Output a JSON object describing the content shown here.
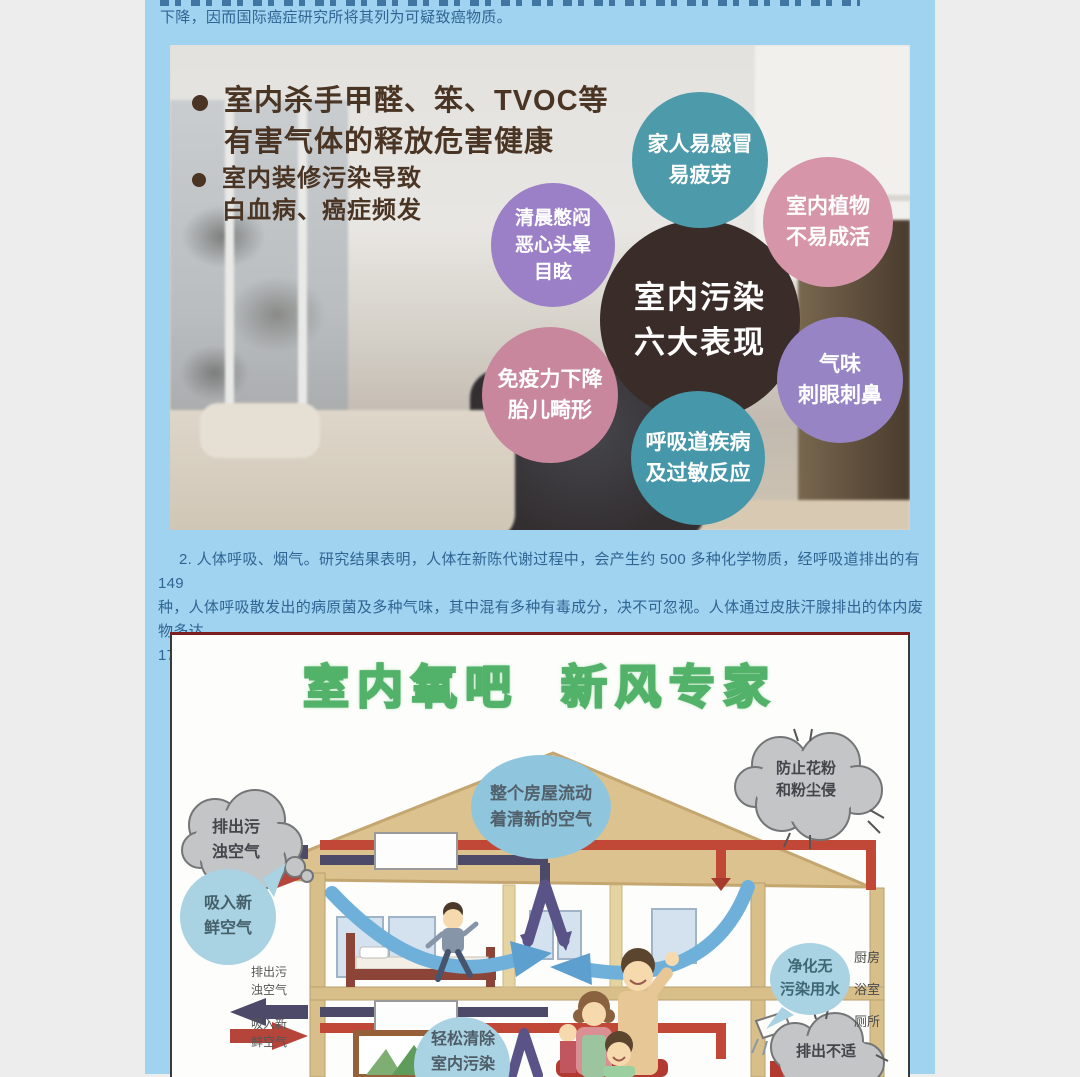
{
  "article": {
    "line_cut": "下降，因而国际癌症研究所将其列为可疑致癌物质。",
    "para2": {
      "l1": "2. 人体呼吸、烟气。研究结果表明，人体在新陈代谢过程中，会产生约 500 多种化学物质，经呼吸道排出的有 149",
      "l2": "种，人体呼吸散发出的病原菌及多种气味，其中混有多种有毒成分，决不可忽视。人体通过皮肤汗腺排出的体内废物多达",
      "l3": "171 种，例如尿素、氨等。"
    }
  },
  "info1": {
    "bullet1_l1": "室内杀手甲醛、笨、TVOC等",
    "bullet1_l2": "有害气体的释放危害健康",
    "bullet2_l1": "室内装修污染导致",
    "bullet2_l2": "白血病、癌症频发",
    "center_l1": "室内污染",
    "center_l2": "六大表现",
    "c_family_l1": "家人易感冒",
    "c_family_l2": "易疲劳",
    "c_plant_l1": "室内植物",
    "c_plant_l2": "不易成活",
    "c_morning_l1": "清晨憋闷",
    "c_morning_l2": "恶心头晕",
    "c_morning_l3": "目眩",
    "c_immune_l1": "免疫力下降",
    "c_immune_l2": "胎儿畸形",
    "c_resp_l1": "呼吸道疾病",
    "c_resp_l2": "及过敏反应",
    "c_odor_l1": "气味",
    "c_odor_l2": "刺眼刺鼻",
    "colors": {
      "center": "#3a2d29",
      "family": "#4d9aab",
      "plant": "#d695a9",
      "morning": "#9b7fc7",
      "immune": "#c9879d",
      "resp": "#4697a9",
      "odor": "#9784c5"
    }
  },
  "info2": {
    "title1": "室内氧吧",
    "title2": "新风专家",
    "roof_l1": "整个房屋流动",
    "roof_l2": "着清新的空气",
    "pollen_l1": "防止花粉",
    "pollen_l2": "和粉尘侵",
    "exhaust_l1": "排出污",
    "exhaust_l2": "浊空气",
    "fresh_l1": "吸入新",
    "fresh_l2": "鲜空气",
    "exhaust_s_l1": "排出污",
    "exhaust_s_l2": "浊空气",
    "fresh_s_l1": "吸入新",
    "fresh_s_l2": "鲜空气",
    "clean_l1": "轻松清除",
    "clean_l2": "室内污染",
    "water_l1": "净化无",
    "water_l2": "污染用水",
    "out_l1": "排出不适",
    "room1": "厨房",
    "room2": "浴室",
    "room3": "厕所",
    "colors": {
      "title_green": "#53b269",
      "pipe_red": "#c14837",
      "pipe_navy": "#4c4a68",
      "bubble_blue": "#a9d2e3"
    }
  },
  "page_colors": {
    "column_bg": "#a0d3f0",
    "margin_bg": "#ededed",
    "body_text": "#2f6593"
  }
}
